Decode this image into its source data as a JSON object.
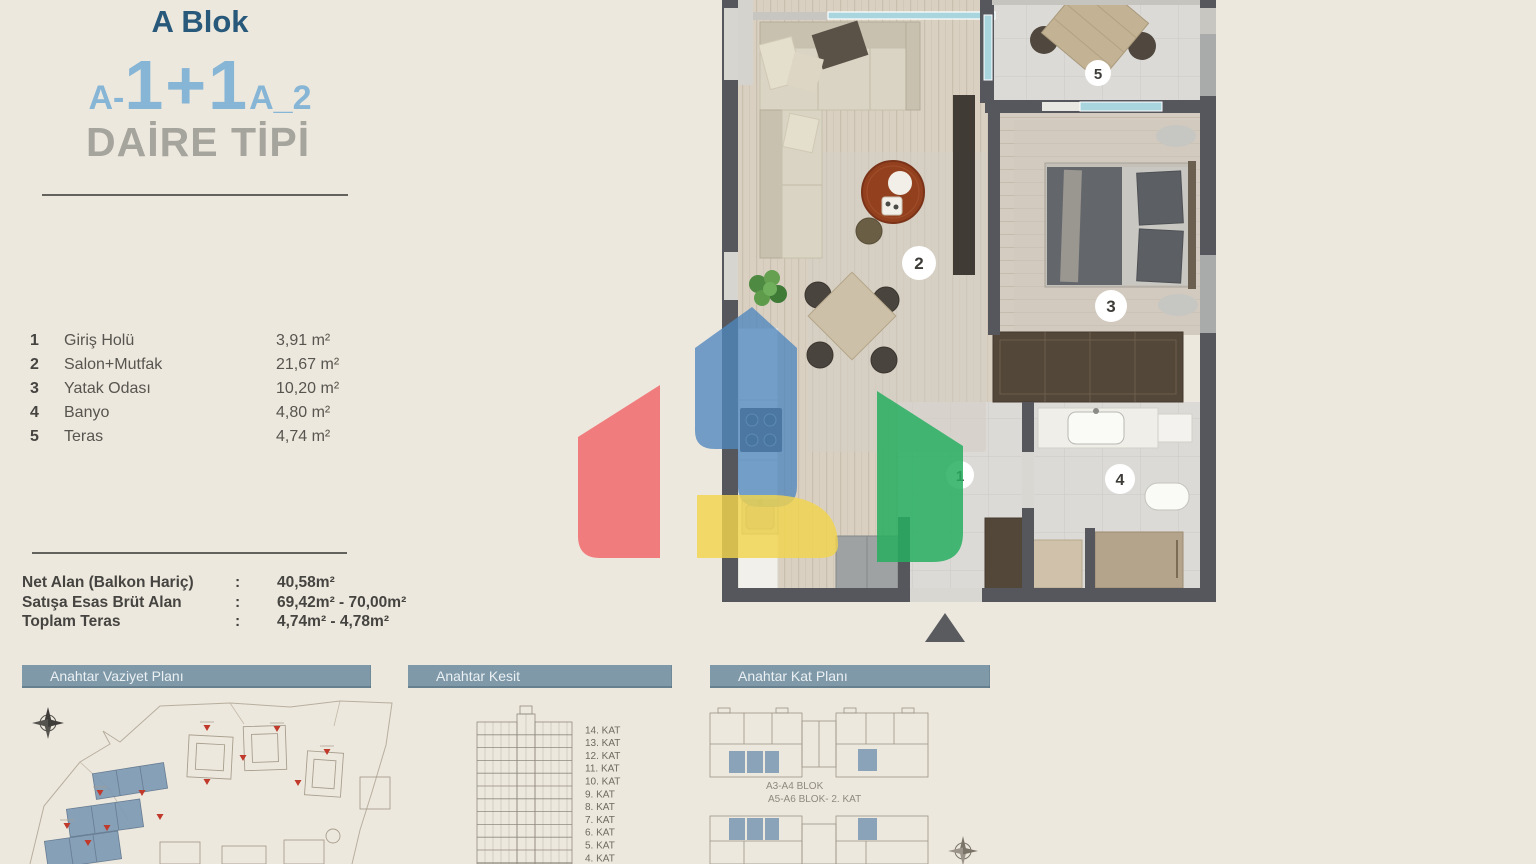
{
  "title": {
    "block": "A Blok",
    "code_prefix": "A-",
    "code_main": "1+1",
    "code_suffix": "A_2",
    "subtitle": "DAİRE TİPİ"
  },
  "rooms": [
    {
      "num": "1",
      "name": "Giriş Holü",
      "area": "3,91 m²"
    },
    {
      "num": "2",
      "name": "Salon+Mutfak",
      "area": "21,67 m²"
    },
    {
      "num": "3",
      "name": "Yatak Odası",
      "area": "10,20 m²"
    },
    {
      "num": "4",
      "name": "Banyo",
      "area": "4,80 m²"
    },
    {
      "num": "5",
      "name": "Teras",
      "area": "4,74 m²"
    }
  ],
  "summary": [
    {
      "label": "Net Alan (Balkon Hariç)",
      "sep": ":",
      "value": "40,58m²"
    },
    {
      "label": "Satışa Esas Brüt Alan",
      "sep": ":",
      "value": "69,42m² - 70,00m²"
    },
    {
      "label": "Toplam Teras",
      "sep": ":",
      "value": "4,74m² - 4,78m²"
    }
  ],
  "section_headers": {
    "site_plan": "Anahtar Vaziyet Planı",
    "section": "Anahtar Kesit",
    "key_plan": "Anahtar Kat Planı"
  },
  "kesit_floors": [
    "14. KAT",
    "13. KAT",
    "12. KAT",
    "11. KAT",
    "10. KAT",
    "9. KAT",
    "8. KAT",
    "7. KAT",
    "6. KAT",
    "5. KAT",
    "4. KAT"
  ],
  "key_plan_labels": {
    "line1": "A3-A4 BLOK",
    "line2": "A5-A6 BLOK- 2. KAT"
  },
  "plan_markers": {
    "m1": "1",
    "m2": "2",
    "m3": "3",
    "m4": "4",
    "m5": "5"
  },
  "colors": {
    "background": "#EDE8DE",
    "title_blue": "#28597A",
    "accent_light_blue": "#86B5D5",
    "subtitle_gray": "#A5A49D",
    "bar_background": "#7F99A8",
    "wall_dark": "#55575C",
    "window_glass": "#A9D6DE",
    "unit_highlight": "#7E9AB5",
    "logo_red": "#F0696C",
    "logo_blue": "#4F86BE",
    "logo_green": "#27AE60",
    "logo_yellow": "#F2D44D"
  }
}
